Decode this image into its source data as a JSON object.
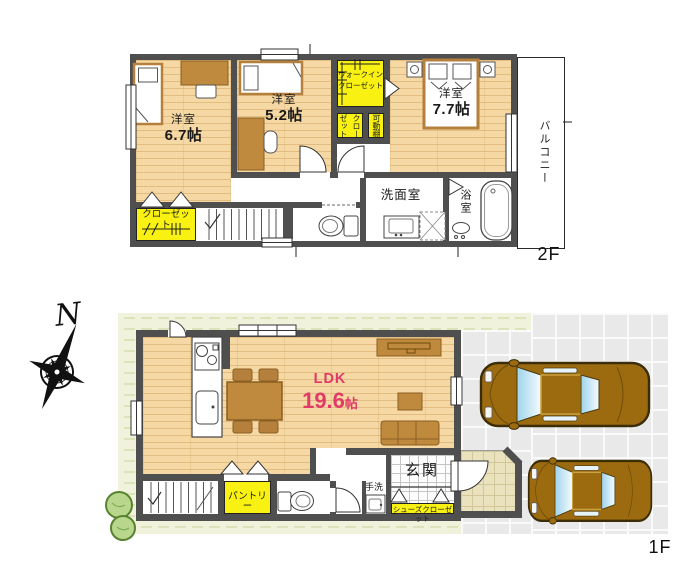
{
  "floor2": {
    "label": "2F",
    "bedroom1_name": "洋室",
    "bedroom1_size": "6.7帖",
    "bedroom2_name": "洋室",
    "bedroom2_size": "5.2帖",
    "bedroom3_name": "洋室",
    "bedroom3_size": "7.7帖",
    "wic_line1": "ウォークイン",
    "wic_line2": "クローゼット",
    "closet_vertical": "クローゼット",
    "movable_shelf": "可動棚",
    "closet_bottom": "クローゼット",
    "washroom": "洗面室",
    "bathroom": "浴室",
    "balcony": "バルコニー"
  },
  "floor1": {
    "label": "1F",
    "ldk_name": "LDK",
    "ldk_size_value": "19.6",
    "ldk_size_unit": "帖",
    "entrance": "玄関",
    "hand_wash": "手洗",
    "shoe_closet": "シューズクローゼット",
    "pantry": "パントリー"
  },
  "compass": {
    "north": "N"
  },
  "colors": {
    "wood_floor": "#f5d8a3",
    "wall": "#4f4f4f",
    "closet_yellow": "#f8f112",
    "ldk_text": "#e03a68",
    "car_body": "#9c6b10",
    "site_green": "#f0f2dc"
  }
}
